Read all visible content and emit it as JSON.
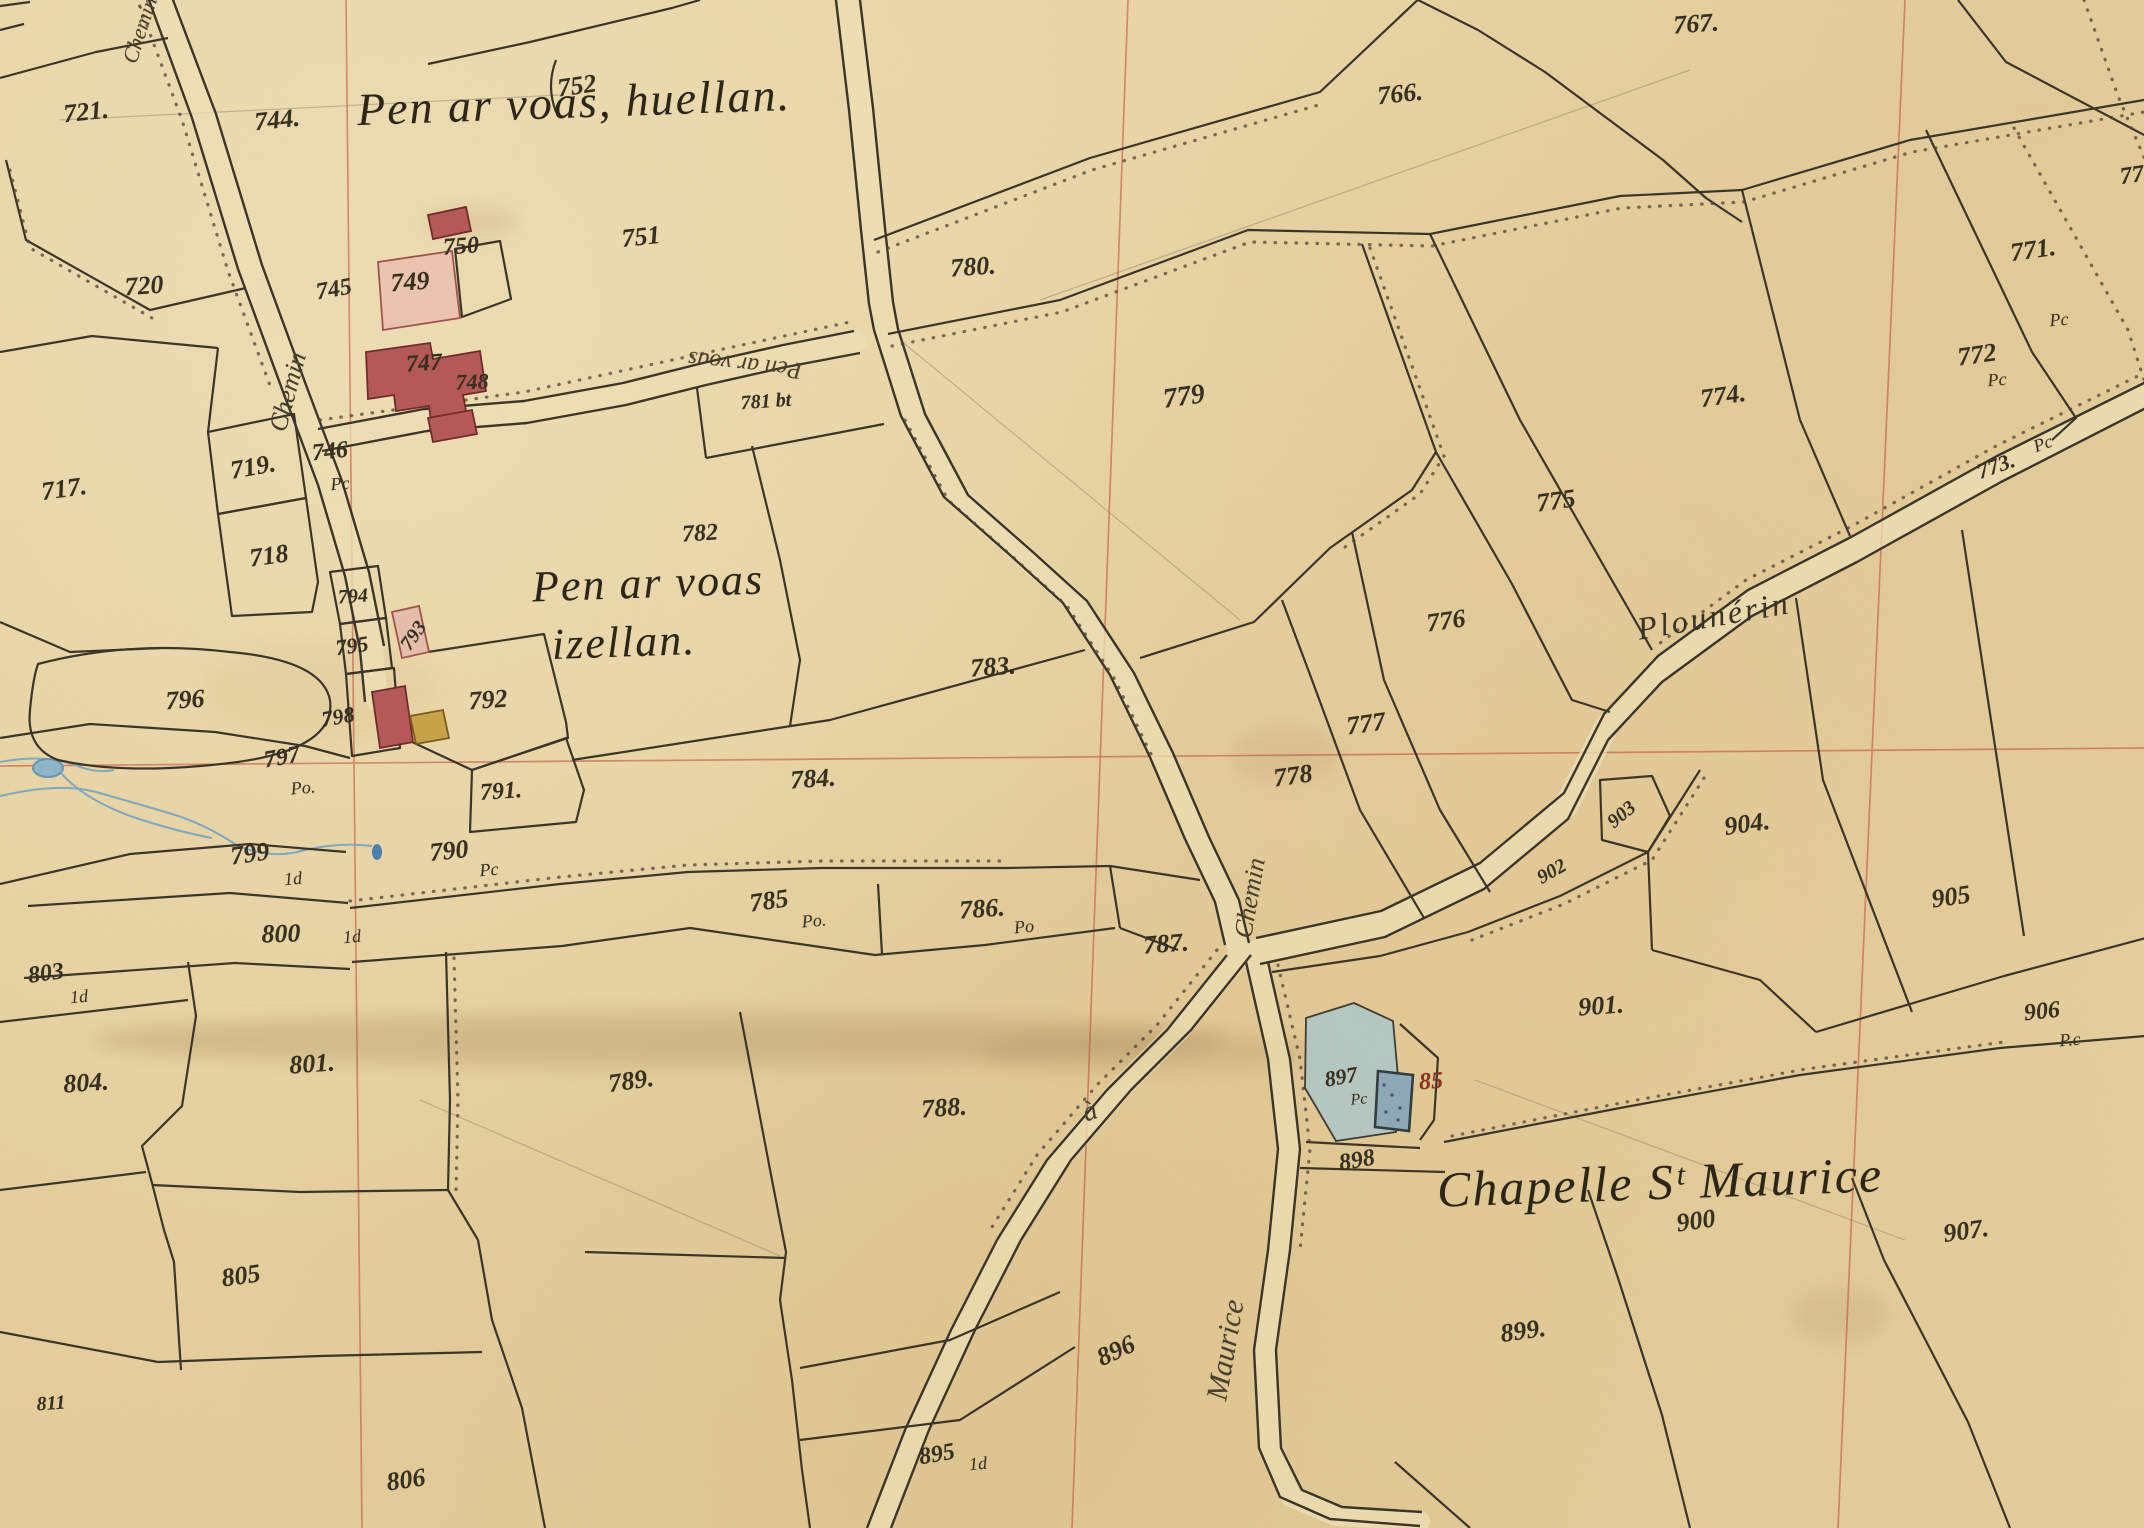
{
  "map_type": "historic-cadastral-plan",
  "colors": {
    "parchment": "#e9d5a6",
    "ink": "#3a3226",
    "grid_red": "#c14934",
    "water_blue": "#7fa9c2",
    "building_red": "#b5575a",
    "courtyard_pink": "#edc6b2",
    "building_yellow": "#c9a347",
    "chapel_enclosure_blue": "#aec8cd",
    "chapel_building_blue": "#8fa9b9",
    "building_number_red": "#8a3324"
  },
  "labels": [
    {
      "type": "title",
      "text": "Pen ar voas, huellan.",
      "x": 574,
      "y": 102,
      "rot": -2,
      "size": 46
    },
    {
      "type": "title",
      "text": "Pen ar voas",
      "x": 648,
      "y": 583,
      "rot": -2,
      "size": 44
    },
    {
      "type": "title",
      "text": "izellan.",
      "x": 624,
      "y": 642,
      "rot": -2,
      "size": 44
    },
    {
      "type": "title",
      "text": "Chapelle Sᵗ Maurice",
      "x": 1660,
      "y": 1182,
      "rot": -2,
      "size": 50
    },
    {
      "type": "place",
      "text": "Plounérin",
      "x": 1714,
      "y": 616,
      "rot": -10,
      "size": 32
    },
    {
      "type": "road",
      "text": "Chemin",
      "x": 140,
      "y": 30,
      "rot": -72,
      "size": 22
    },
    {
      "type": "road",
      "text": "Chemin",
      "x": 288,
      "y": 392,
      "rot": -75,
      "size": 26
    },
    {
      "type": "road",
      "text": "Chemin",
      "x": 1250,
      "y": 898,
      "rot": -80,
      "size": 26
    },
    {
      "type": "road",
      "text": "à",
      "x": 1090,
      "y": 1112,
      "rot": -20,
      "size": 28
    },
    {
      "type": "road",
      "text": "Maurice",
      "x": 1226,
      "y": 1350,
      "rot": -80,
      "size": 30
    },
    {
      "type": "road",
      "text": "Pen ar voas",
      "x": 745,
      "y": 364,
      "rot": 186,
      "size": 24
    },
    {
      "type": "parcel",
      "text": "721.",
      "x": 86,
      "y": 112,
      "rot": -6,
      "size": 26
    },
    {
      "type": "parcel",
      "text": "744.",
      "x": 277,
      "y": 120,
      "rot": -6,
      "size": 26
    },
    {
      "type": "parcel",
      "text": "752",
      "x": 577,
      "y": 86,
      "rot": -8,
      "size": 26
    },
    {
      "type": "parcel",
      "text": "720",
      "x": 144,
      "y": 286,
      "rot": -4,
      "size": 26
    },
    {
      "type": "parcel",
      "text": "745",
      "x": 334,
      "y": 290,
      "rot": -10,
      "size": 24
    },
    {
      "type": "parcel",
      "text": "749",
      "x": 410,
      "y": 282,
      "rot": -4,
      "size": 26
    },
    {
      "type": "parcel",
      "text": "750",
      "x": 461,
      "y": 247,
      "rot": -4,
      "size": 24
    },
    {
      "type": "parcel",
      "text": "751",
      "x": 641,
      "y": 237,
      "rot": -6,
      "size": 26
    },
    {
      "type": "parcel",
      "text": "747",
      "x": 424,
      "y": 364,
      "rot": -4,
      "size": 24
    },
    {
      "type": "parcel",
      "text": "748",
      "x": 472,
      "y": 382,
      "rot": -2,
      "size": 22
    },
    {
      "type": "parcel",
      "text": "746",
      "x": 330,
      "y": 452,
      "rot": -6,
      "size": 24
    },
    {
      "type": "sub",
      "text": "Pc",
      "x": 340,
      "y": 484,
      "rot": -5,
      "size": 18
    },
    {
      "type": "parcel",
      "text": "717.",
      "x": 64,
      "y": 489,
      "rot": -8,
      "size": 26
    },
    {
      "type": "parcel",
      "text": "719.",
      "x": 253,
      "y": 467,
      "rot": -10,
      "size": 26
    },
    {
      "type": "parcel",
      "text": "718",
      "x": 269,
      "y": 556,
      "rot": -8,
      "size": 26
    },
    {
      "type": "parcel",
      "text": "794",
      "x": 353,
      "y": 597,
      "rot": -4,
      "size": 20
    },
    {
      "type": "parcel",
      "text": "795",
      "x": 352,
      "y": 646,
      "rot": -8,
      "size": 22
    },
    {
      "type": "parcel",
      "text": "793",
      "x": 414,
      "y": 636,
      "rot": -55,
      "size": 20
    },
    {
      "type": "parcel",
      "text": "798",
      "x": 338,
      "y": 717,
      "rot": -10,
      "size": 22
    },
    {
      "type": "parcel",
      "text": "792",
      "x": 488,
      "y": 700,
      "rot": -4,
      "size": 26
    },
    {
      "type": "parcel",
      "text": "796",
      "x": 185,
      "y": 700,
      "rot": -4,
      "size": 26
    },
    {
      "type": "parcel",
      "text": "797",
      "x": 282,
      "y": 758,
      "rot": -10,
      "size": 24
    },
    {
      "type": "sub",
      "text": "Po.",
      "x": 303,
      "y": 788,
      "rot": -5,
      "size": 18
    },
    {
      "type": "parcel",
      "text": "791.",
      "x": 501,
      "y": 792,
      "rot": -4,
      "size": 24
    },
    {
      "type": "parcel",
      "text": "790",
      "x": 449,
      "y": 851,
      "rot": -6,
      "size": 26
    },
    {
      "type": "sub",
      "text": "Pc",
      "x": 489,
      "y": 870,
      "rot": -5,
      "size": 18
    },
    {
      "type": "parcel",
      "text": "799",
      "x": 250,
      "y": 854,
      "rot": -8,
      "size": 26
    },
    {
      "type": "sub",
      "text": "1d",
      "x": 293,
      "y": 879,
      "rot": -5,
      "size": 18
    },
    {
      "type": "parcel",
      "text": "800",
      "x": 281,
      "y": 934,
      "rot": -2,
      "size": 26
    },
    {
      "type": "sub",
      "text": "1d",
      "x": 352,
      "y": 937,
      "rot": -5,
      "size": 18
    },
    {
      "type": "parcel",
      "text": "803",
      "x": 46,
      "y": 974,
      "rot": -8,
      "size": 24
    },
    {
      "type": "sub",
      "text": "1d",
      "x": 79,
      "y": 997,
      "rot": -5,
      "size": 18
    },
    {
      "type": "parcel",
      "text": "804.",
      "x": 86,
      "y": 1083,
      "rot": -4,
      "size": 26
    },
    {
      "type": "parcel",
      "text": "801.",
      "x": 312,
      "y": 1064,
      "rot": -4,
      "size": 26
    },
    {
      "type": "parcel",
      "text": "805",
      "x": 241,
      "y": 1276,
      "rot": -8,
      "size": 26
    },
    {
      "type": "parcel",
      "text": "811",
      "x": 51,
      "y": 1404,
      "rot": -4,
      "size": 20
    },
    {
      "type": "parcel",
      "text": "806",
      "x": 406,
      "y": 1480,
      "rot": -8,
      "size": 26
    },
    {
      "type": "parcel",
      "text": "782",
      "x": 700,
      "y": 534,
      "rot": -4,
      "size": 24
    },
    {
      "type": "parcel",
      "text": "781 bt",
      "x": 766,
      "y": 402,
      "rot": -4,
      "size": 20
    },
    {
      "type": "parcel",
      "text": "783.",
      "x": 993,
      "y": 667,
      "rot": -4,
      "size": 26
    },
    {
      "type": "parcel",
      "text": "784.",
      "x": 813,
      "y": 779,
      "rot": -4,
      "size": 26
    },
    {
      "type": "parcel",
      "text": "785",
      "x": 769,
      "y": 901,
      "rot": -8,
      "size": 26
    },
    {
      "type": "sub",
      "text": "Po.",
      "x": 814,
      "y": 921,
      "rot": -5,
      "size": 18
    },
    {
      "type": "parcel",
      "text": "786.",
      "x": 982,
      "y": 909,
      "rot": -4,
      "size": 26
    },
    {
      "type": "sub",
      "text": "Po",
      "x": 1024,
      "y": 927,
      "rot": -5,
      "size": 18
    },
    {
      "type": "parcel",
      "text": "787.",
      "x": 1166,
      "y": 944,
      "rot": -4,
      "size": 26
    },
    {
      "type": "parcel",
      "text": "788.",
      "x": 944,
      "y": 1108,
      "rot": -4,
      "size": 26
    },
    {
      "type": "parcel",
      "text": "789.",
      "x": 631,
      "y": 1081,
      "rot": -8,
      "size": 26
    },
    {
      "type": "parcel",
      "text": "780.",
      "x": 973,
      "y": 267,
      "rot": -4,
      "size": 26
    },
    {
      "type": "parcel",
      "text": "779",
      "x": 1184,
      "y": 397,
      "rot": -8,
      "size": 28
    },
    {
      "type": "parcel",
      "text": "766.",
      "x": 1400,
      "y": 94,
      "rot": -6,
      "size": 26
    },
    {
      "type": "parcel",
      "text": "767.",
      "x": 1696,
      "y": 24,
      "rot": -4,
      "size": 26
    },
    {
      "type": "parcel",
      "text": "77",
      "x": 2132,
      "y": 176,
      "rot": -8,
      "size": 24
    },
    {
      "type": "parcel",
      "text": "771.",
      "x": 2033,
      "y": 250,
      "rot": -8,
      "size": 26
    },
    {
      "type": "sub",
      "text": "Pc",
      "x": 2059,
      "y": 320,
      "rot": -5,
      "size": 18
    },
    {
      "type": "parcel",
      "text": "772",
      "x": 1977,
      "y": 355,
      "rot": -8,
      "size": 26
    },
    {
      "type": "sub",
      "text": "Pc",
      "x": 1997,
      "y": 380,
      "rot": -5,
      "size": 18
    },
    {
      "type": "parcel",
      "text": "774.",
      "x": 1723,
      "y": 396,
      "rot": -8,
      "size": 26
    },
    {
      "type": "parcel",
      "text": "773.",
      "x": 1996,
      "y": 466,
      "rot": -20,
      "size": 22
    },
    {
      "type": "sub",
      "text": "Pc",
      "x": 2043,
      "y": 444,
      "rot": -20,
      "size": 18
    },
    {
      "type": "parcel",
      "text": "775",
      "x": 1556,
      "y": 501,
      "rot": -8,
      "size": 26
    },
    {
      "type": "parcel",
      "text": "776",
      "x": 1446,
      "y": 621,
      "rot": -8,
      "size": 26
    },
    {
      "type": "parcel",
      "text": "777",
      "x": 1366,
      "y": 724,
      "rot": -8,
      "size": 26
    },
    {
      "type": "parcel",
      "text": "778",
      "x": 1293,
      "y": 776,
      "rot": -8,
      "size": 26
    },
    {
      "type": "parcel",
      "text": "903",
      "x": 1622,
      "y": 815,
      "rot": -40,
      "size": 20
    },
    {
      "type": "parcel",
      "text": "902",
      "x": 1552,
      "y": 872,
      "rot": -30,
      "size": 20
    },
    {
      "type": "parcel",
      "text": "904.",
      "x": 1747,
      "y": 824,
      "rot": -8,
      "size": 26
    },
    {
      "type": "parcel",
      "text": "905",
      "x": 1951,
      "y": 897,
      "rot": -8,
      "size": 26
    },
    {
      "type": "parcel",
      "text": "906",
      "x": 2042,
      "y": 1012,
      "rot": -6,
      "size": 24
    },
    {
      "type": "sub",
      "text": "P.c",
      "x": 2070,
      "y": 1040,
      "rot": -5,
      "size": 18
    },
    {
      "type": "parcel",
      "text": "901.",
      "x": 1601,
      "y": 1006,
      "rot": -4,
      "size": 26
    },
    {
      "type": "parcel",
      "text": "897",
      "x": 1341,
      "y": 1077,
      "rot": -10,
      "size": 22
    },
    {
      "type": "sub",
      "text": "Pc",
      "x": 1359,
      "y": 1100,
      "rot": -5,
      "size": 16
    },
    {
      "type": "building",
      "text": "85",
      "x": 1431,
      "y": 1082,
      "rot": -4,
      "size": 24
    },
    {
      "type": "parcel",
      "text": "898",
      "x": 1357,
      "y": 1161,
      "rot": -10,
      "size": 24
    },
    {
      "type": "parcel",
      "text": "900",
      "x": 1696,
      "y": 1221,
      "rot": -8,
      "size": 26
    },
    {
      "type": "parcel",
      "text": "907.",
      "x": 1966,
      "y": 1231,
      "rot": -8,
      "size": 26
    },
    {
      "type": "parcel",
      "text": "899.",
      "x": 1523,
      "y": 1331,
      "rot": -8,
      "size": 26
    },
    {
      "type": "parcel",
      "text": "896",
      "x": 1116,
      "y": 1351,
      "rot": -25,
      "size": 26
    },
    {
      "type": "parcel",
      "text": "895",
      "x": 937,
      "y": 1455,
      "rot": -10,
      "size": 24
    },
    {
      "type": "sub",
      "text": "1d",
      "x": 978,
      "y": 1464,
      "rot": -5,
      "size": 18
    }
  ]
}
